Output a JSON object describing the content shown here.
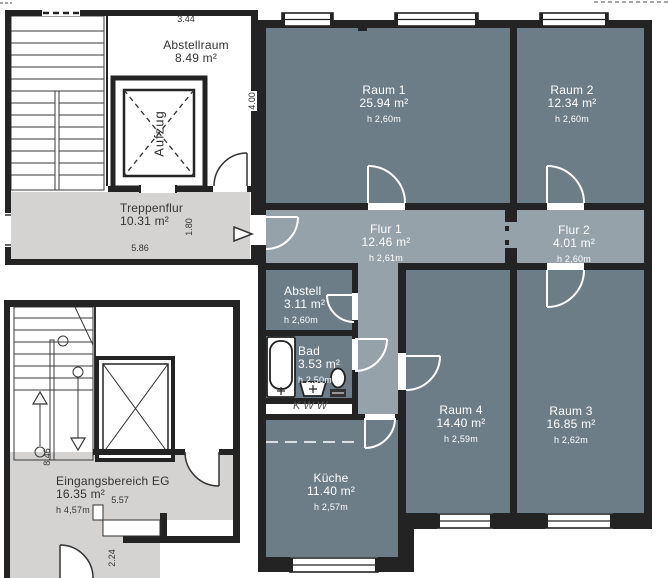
{
  "floorplan": {
    "rooms": {
      "abstellraum": {
        "name": "Abstellraum",
        "area": "8.49 m²"
      },
      "raum1": {
        "name": "Raum 1",
        "area": "25.94 m²",
        "height": "h 2,60m"
      },
      "raum2": {
        "name": "Raum 2",
        "area": "12.34 m²",
        "height": "h 2,60m"
      },
      "treppenflur": {
        "name": "Treppenflur",
        "area": "10.31 m²"
      },
      "flur1": {
        "name": "Flur 1",
        "area": "12.46 m²",
        "height": "h 2,61m"
      },
      "flur2": {
        "name": "Flur 2",
        "area": "4.01 m²",
        "height": "h 2,60m"
      },
      "abstell": {
        "name": "Abstell",
        "area": "3.11 m²",
        "height": "h 2,60m"
      },
      "bad": {
        "name": "Bad",
        "area": "3.53 m²",
        "height": "h 2,50m"
      },
      "kueche": {
        "name": "Küche",
        "area": "11.40 m²",
        "height": "h 2,57m"
      },
      "raum4": {
        "name": "Raum 4",
        "area": "14.40 m²",
        "height": "h 2,59m"
      },
      "raum3": {
        "name": "Raum 3",
        "area": "16.85 m²",
        "height": "h 2,62m"
      },
      "eingangsbereich": {
        "name": "Eingangsbereich EG",
        "area": "16.35 m²",
        "height": "h 4,57m"
      }
    },
    "labels": {
      "aufzug": "Aufzug",
      "kww": "KWW"
    },
    "dimensions": {
      "abstellraum_width": "3.44",
      "abstellraum_depth": "4.00",
      "treppenflur_width": "5.86",
      "treppenflur_depth": "1.80",
      "eg_stair_depth": "8.46",
      "eg_width": "5.57",
      "eg_bottom_width": "2.24"
    },
    "colors": {
      "wall": "#232323",
      "room_dark": "#6d7d88",
      "room_flur": "#95a2aa",
      "room_light": "#d4d3d1",
      "line": "#333333"
    }
  }
}
